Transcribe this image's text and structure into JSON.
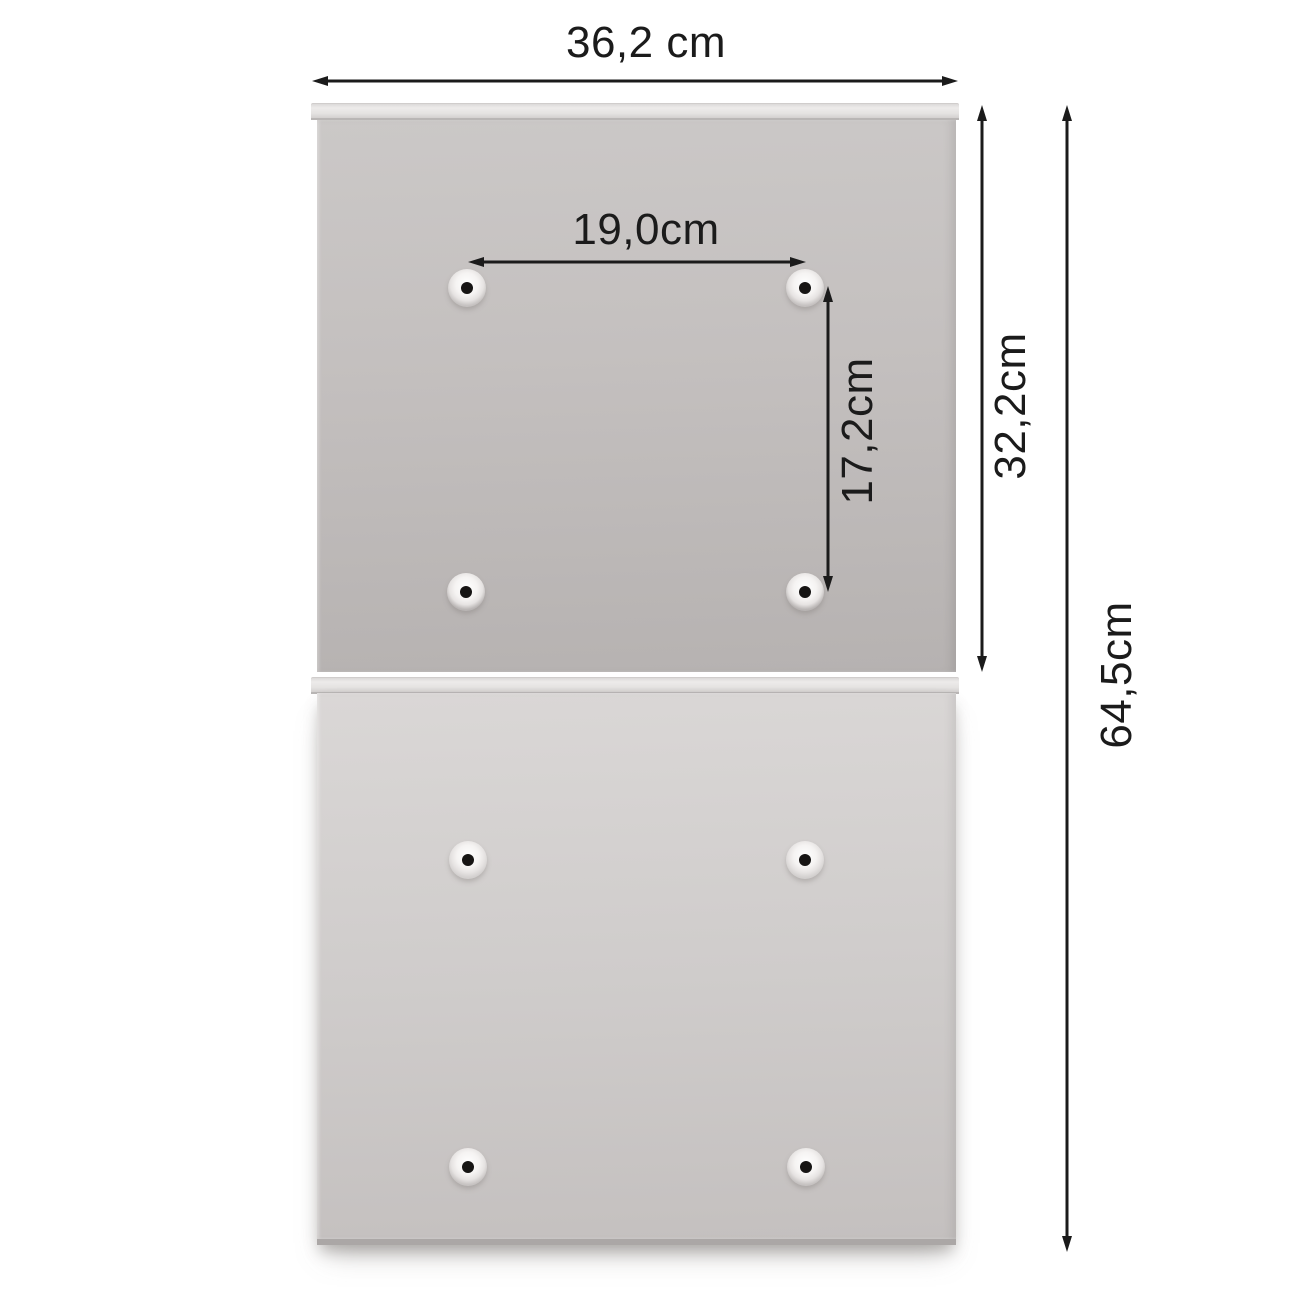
{
  "diagram": {
    "dimension_labels": {
      "overall_width": "36,2 cm",
      "hole_spacing_horizontal": "19,0cm",
      "hole_spacing_vertical": "17,2cm",
      "upper_panel_height": "32,2cm",
      "total_height": "64,5cm"
    },
    "colors": {
      "background": "#ffffff",
      "panel_light_grey": "#cdc9c8",
      "panel_dark_grey": "#b9b5b4",
      "lip_grey": "#e9e7e6",
      "dimension_line": "#1b1b1b"
    },
    "mounting_holes": {
      "count": 8
    }
  }
}
